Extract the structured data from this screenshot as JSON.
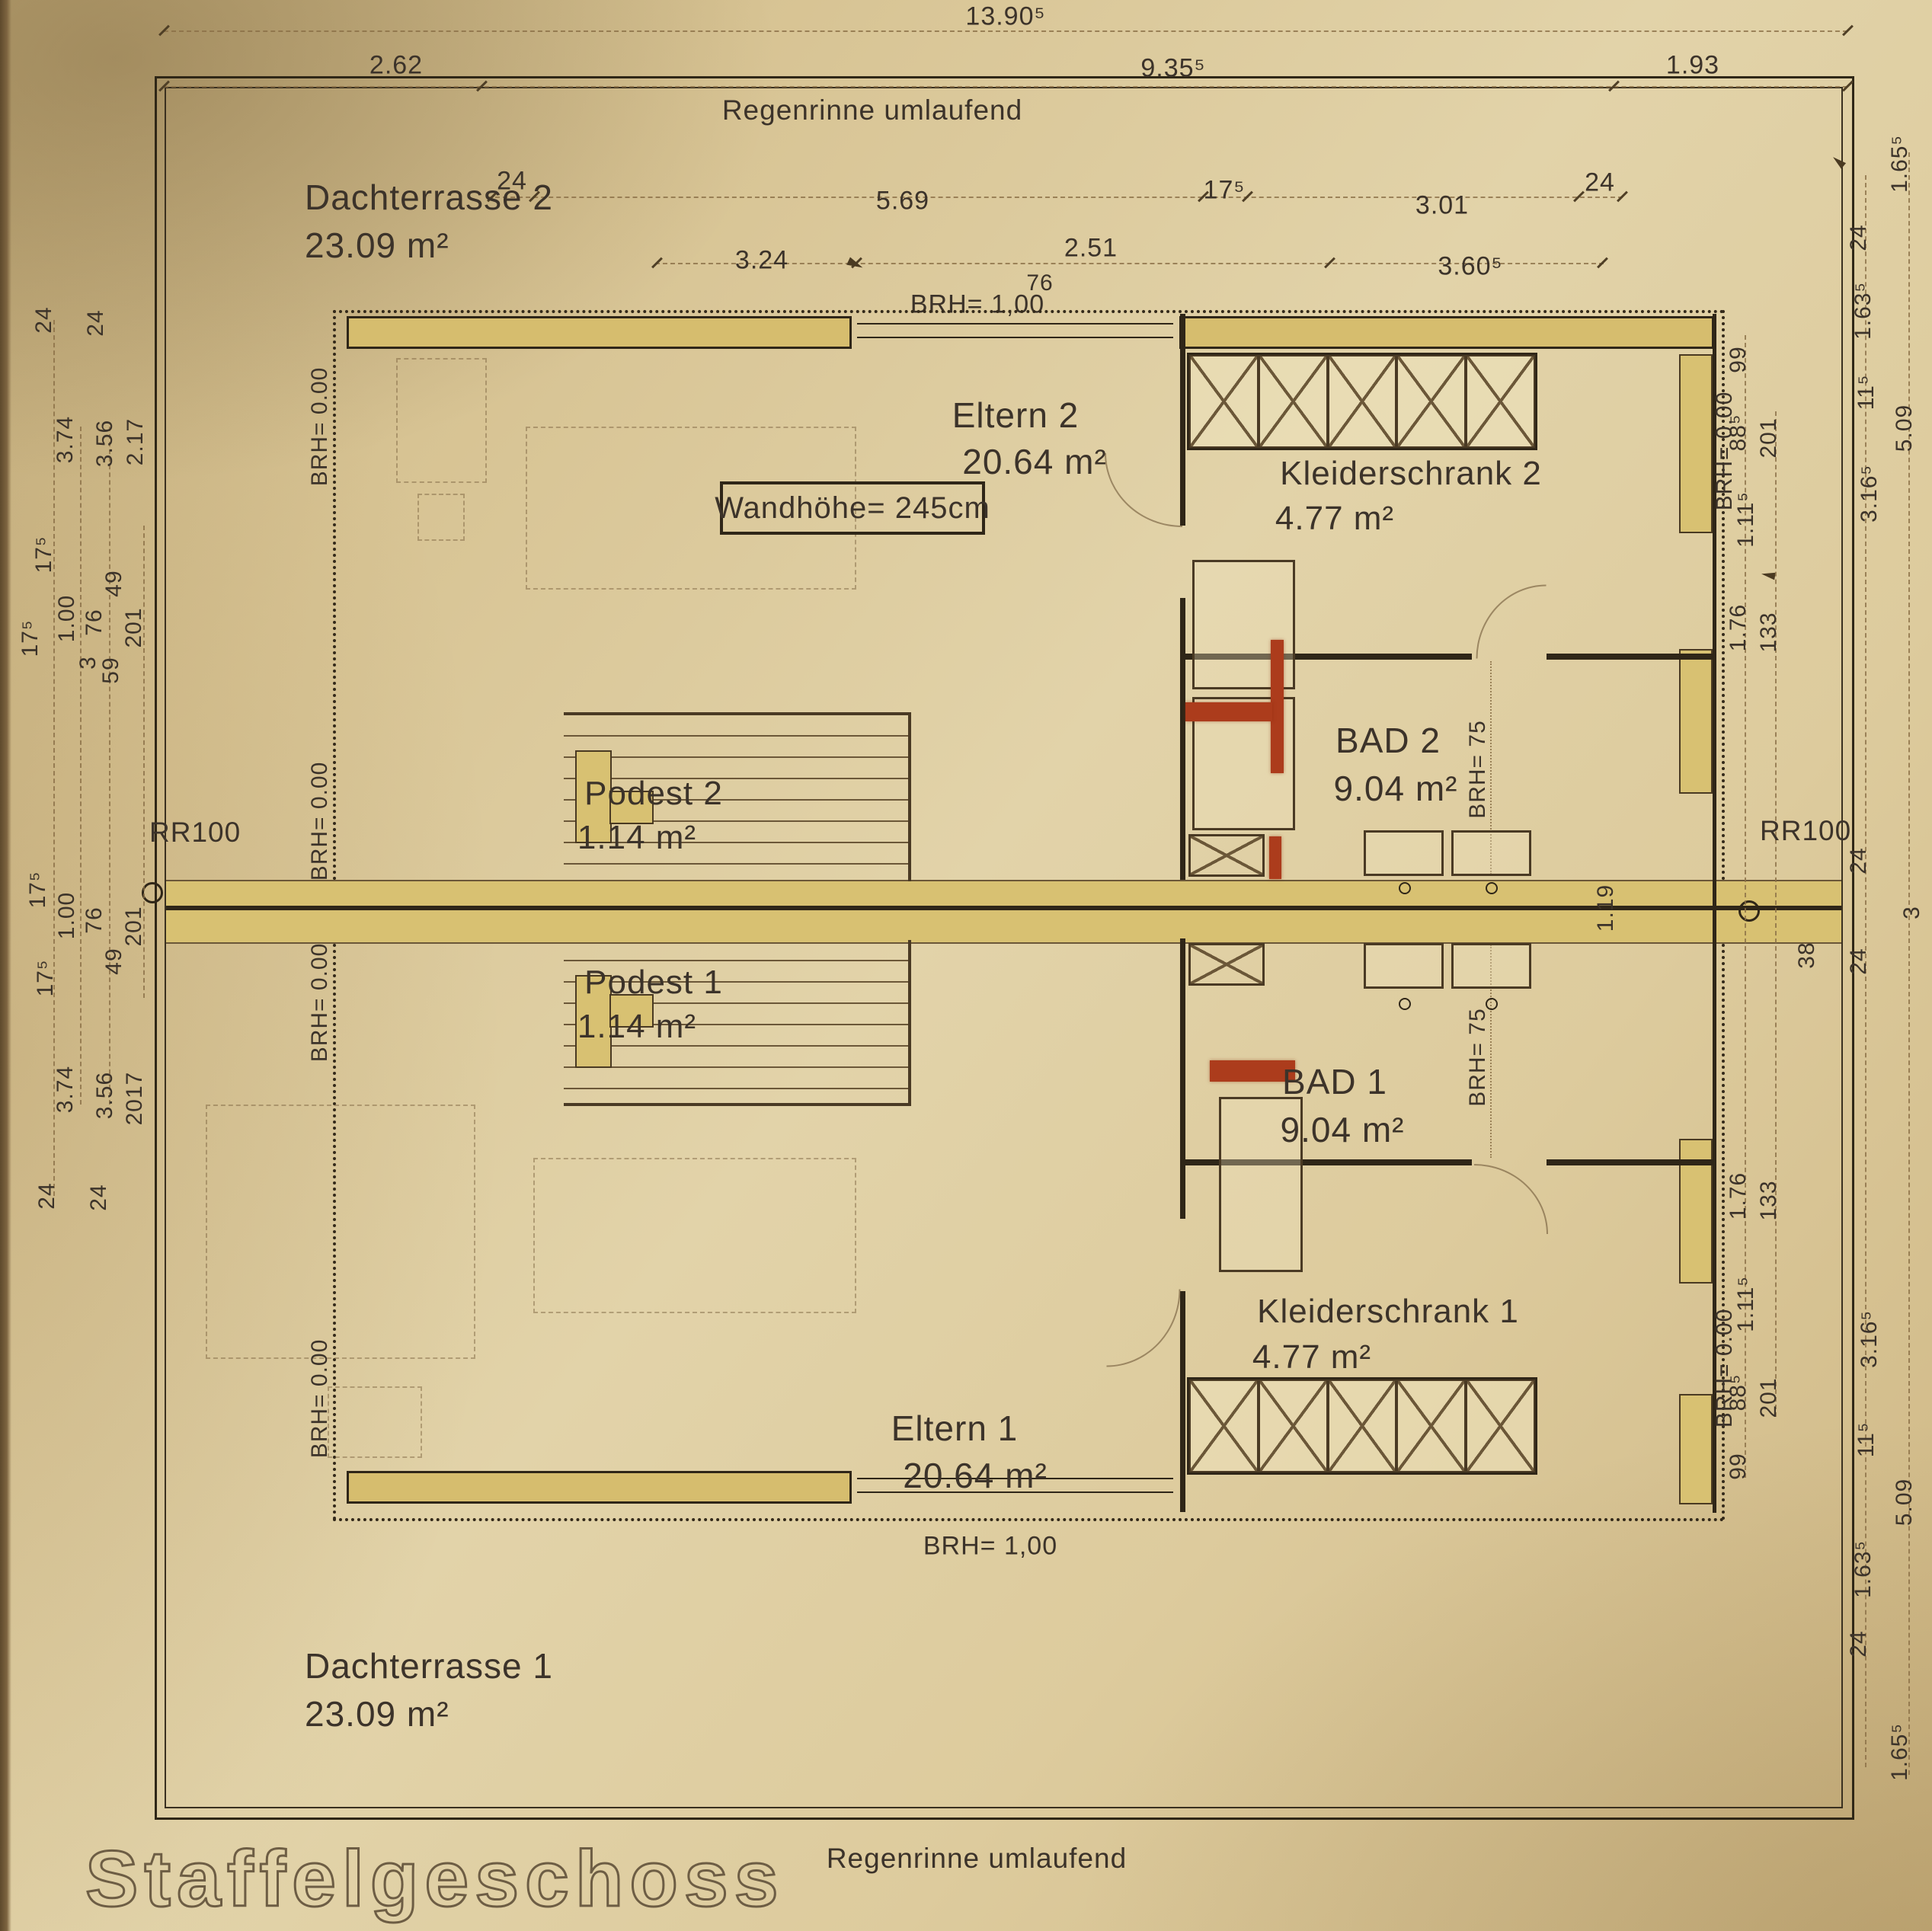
{
  "title": "Staffelgeschoss",
  "annotations": {
    "regenrinne": "Regenrinne umlaufend",
    "wandhoehe": "Wandhöhe= 245cm",
    "brh100": "BRH= 1,00",
    "brh0": "BRH= 0.00",
    "brh75": "BRH= 75",
    "rr100": "RR100"
  },
  "rooms": {
    "dachterrasse2": {
      "name": "Dachterrasse 2",
      "area": "23.09 m²"
    },
    "eltern2": {
      "name": "Eltern 2",
      "area": "20.64 m²"
    },
    "kleiderschrank2": {
      "name": "Kleiderschrank 2",
      "area": "4.77 m²"
    },
    "bad2": {
      "name": "BAD 2",
      "area": "9.04 m²"
    },
    "podest2": {
      "name": "Podest 2",
      "area": "1.14 m²"
    },
    "podest1": {
      "name": "Podest 1",
      "area": "1.14 m²"
    },
    "bad1": {
      "name": "BAD 1",
      "area": "9.04 m²"
    },
    "eltern1": {
      "name": "Eltern 1",
      "area": "20.64 m²"
    },
    "kleiderschrank1": {
      "name": "Kleiderschrank 1",
      "area": "4.77 m²"
    },
    "dachterrasse1": {
      "name": "Dachterrasse 1",
      "area": "23.09 m²"
    }
  },
  "dims": {
    "top_chain": [
      "13.90⁵",
      "2.62",
      "9.35⁵",
      "1.93"
    ],
    "inner_top": [
      "24",
      "5.69",
      "17⁵",
      "3.01",
      "24",
      "3.24",
      "2.51",
      "3.60⁵",
      "76"
    ],
    "left_top": [
      "24",
      "24",
      "3.74",
      "3.56",
      "2.17",
      "17⁵",
      "49",
      "1.00",
      "76",
      "201",
      "17⁵",
      "3",
      "59"
    ],
    "left_bottom": [
      "17⁵",
      "1.00",
      "76",
      "201",
      "49",
      "17⁵",
      "3.74",
      "3.56",
      "2017",
      "24",
      "24"
    ],
    "right_top": [
      "99",
      "88⁵",
      "201",
      "1.11⁵",
      "1.76",
      "133"
    ],
    "right_mid": [
      "24",
      "38",
      "24",
      "3",
      "1.19"
    ],
    "right_bottom": [
      "1.76",
      "133",
      "1.11⁵",
      "88⁵",
      "201",
      "99"
    ],
    "right_outer_top": [
      "1.65⁵",
      "24",
      "1.63⁵",
      "11⁵",
      "5.09",
      "3.16⁵"
    ],
    "right_outer_bottom": [
      "3.16⁵",
      "11⁵",
      "5.09",
      "1.63⁵",
      "24",
      "1.65⁵"
    ]
  },
  "colors": {
    "paper": "#d9c79a",
    "wall_fill": "#d6bd6e",
    "line": "#2f2618",
    "highlight_red": "#ac3c1c",
    "dim_line": "#8a6f46"
  }
}
